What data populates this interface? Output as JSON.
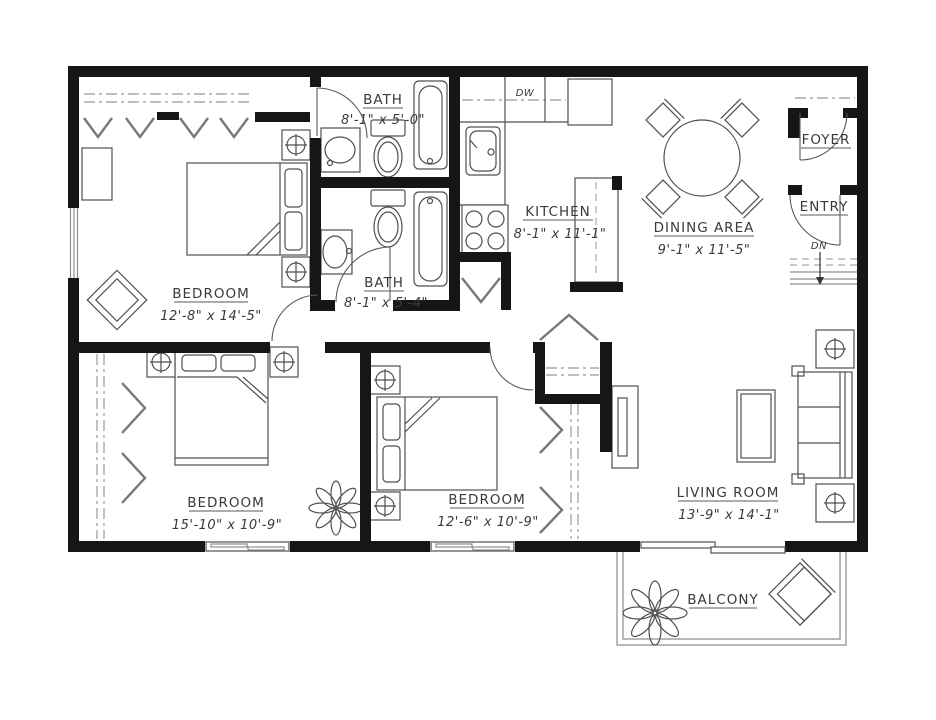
{
  "plan_title": "Two Bedroom + Den Apartment Floor Plan",
  "colors": {
    "wall": "#161616",
    "line": "#4f4f4f",
    "light": "#8d8d8d",
    "background": "#ffffff"
  },
  "rooms": {
    "bath1": {
      "name": "BATH",
      "dims": "8'-1\" x 5'-0\""
    },
    "bath2": {
      "name": "BATH",
      "dims": "8'-1\" x 5'-4\""
    },
    "kitchen": {
      "name": "KITCHEN",
      "dims": "8'-1\" x 11'-1\""
    },
    "dining": {
      "name": "DINING AREA",
      "dims": "9'-1\" x 11'-5\""
    },
    "foyer": {
      "name": "FOYER"
    },
    "entry": {
      "name": "ENTRY"
    },
    "bedroom1": {
      "name": "BEDROOM",
      "dims": "12'-8\" x 14'-5\""
    },
    "bedroom2": {
      "name": "BEDROOM",
      "dims": "15'-10\" x 10'-9\""
    },
    "bedroom3": {
      "name": "BEDROOM",
      "dims": "12'-6\" x 10'-9\""
    },
    "living": {
      "name": "LIVING ROOM",
      "dims": "13'-9\" x 14'-1\""
    },
    "balcony": {
      "name": "BALCONY"
    }
  },
  "annotations": {
    "dishwasher": "DW",
    "stairs_down": "DN"
  }
}
